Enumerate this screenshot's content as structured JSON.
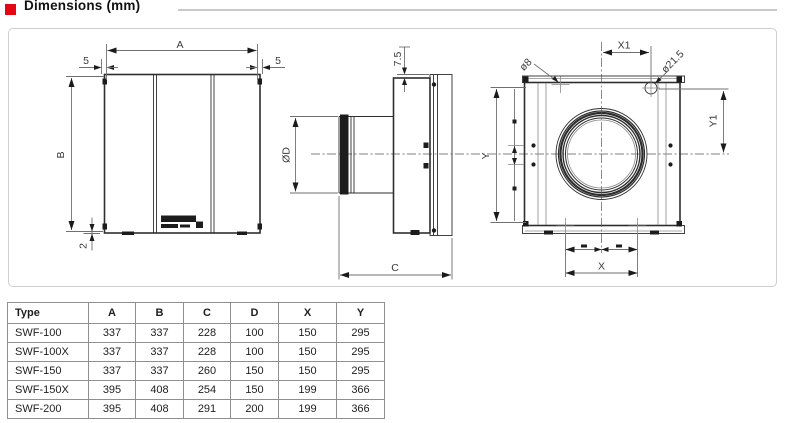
{
  "header": {
    "title": "Dimensions (mm)",
    "accent_color": "#e30613"
  },
  "drawing": {
    "front_view_labels": {
      "width": "A",
      "height": "B",
      "flange_left": "5",
      "flange_right": "5",
      "bottom_lip": "2"
    },
    "side_view_labels": {
      "duct_diameter": "ØD",
      "depth": "C",
      "plate_offset": "7.5"
    },
    "back_view_labels": {
      "hole_diameter": "ø8",
      "knockout_diameter": "ø21.5",
      "hole_offset_x": "X1",
      "hole_offset_y": "Y1",
      "hole_spacing_x": "X",
      "hole_spacing_y": "Y"
    }
  },
  "table": {
    "columns": [
      "Type",
      "A",
      "B",
      "C",
      "D",
      "X",
      "Y"
    ],
    "rows": [
      [
        "SWF-100",
        "337",
        "337",
        "228",
        "100",
        "150",
        "295"
      ],
      [
        "SWF-100X",
        "337",
        "337",
        "228",
        "100",
        "150",
        "295"
      ],
      [
        "SWF-150",
        "337",
        "337",
        "260",
        "150",
        "150",
        "295"
      ],
      [
        "SWF-150X",
        "395",
        "408",
        "254",
        "150",
        "199",
        "366"
      ],
      [
        "SWF-200",
        "395",
        "408",
        "291",
        "200",
        "199",
        "366"
      ]
    ]
  }
}
